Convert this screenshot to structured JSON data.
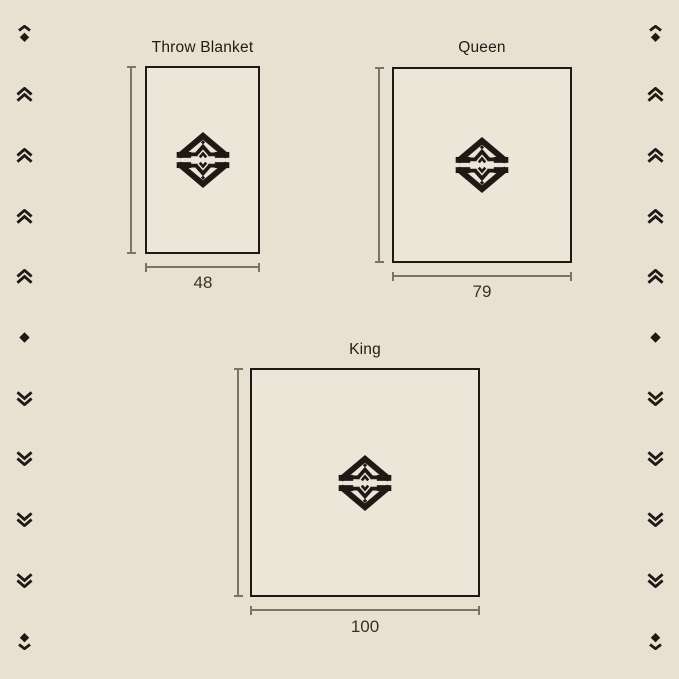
{
  "page": {
    "description": "Blanket size comparison diagram",
    "colors": {
      "background": "#E8E1D2",
      "rect_fill": "#ECE6D8",
      "outline": "#1D1A15",
      "dimension_line": "#7B7466",
      "label_text": "#35312A"
    }
  },
  "figures": [
    {
      "title": "Throw Blanket",
      "height_label": "82",
      "width_label": "48"
    },
    {
      "title": "Queen",
      "height_label": "87",
      "width_label": "79"
    },
    {
      "title": "King",
      "height_label": "100",
      "width_label": "100"
    }
  ],
  "logo": {
    "name": "brand-diamond-monogram"
  },
  "ornaments": {
    "column_icons": [
      "diamond-chevron-up-icon",
      "double-chevron-up-icon",
      "double-chevron-up-icon",
      "double-chevron-up-icon",
      "double-chevron-up-icon",
      "diamond-icon",
      "double-chevron-down-icon",
      "double-chevron-down-icon",
      "double-chevron-down-icon",
      "double-chevron-down-icon",
      "diamond-chevron-down-icon"
    ]
  }
}
